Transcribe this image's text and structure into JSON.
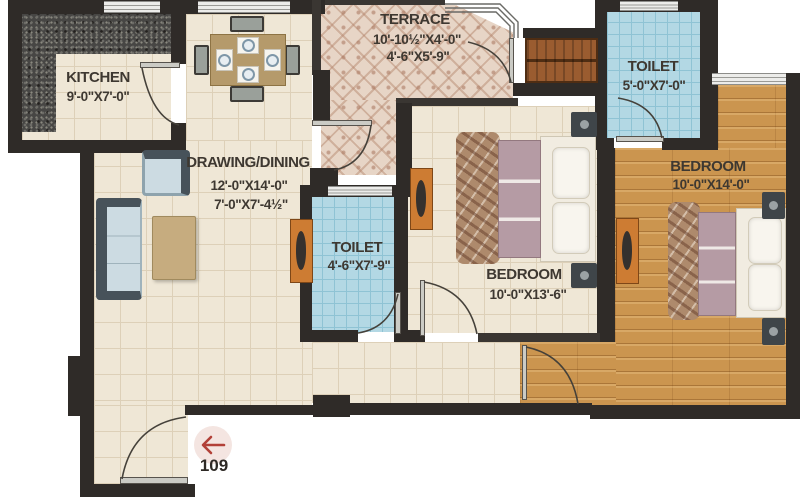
{
  "plan": {
    "unit_number": "109",
    "rooms": {
      "kitchen": {
        "name": "KITCHEN",
        "dims": "9'-0\"X7'-0\""
      },
      "terrace": {
        "name": "TERRACE",
        "dims1": "10'-10½\"X4'-0\"",
        "dims2": "4'-6\"X5'-9\""
      },
      "toilet_top": {
        "name": "TOILET",
        "dims": "5'-0\"X7'-0\""
      },
      "toilet_mid": {
        "name": "TOILET",
        "dims": "4'-6\"X7'-9\""
      },
      "drawing_dining": {
        "name": "DRAWING/DINING",
        "dims1": "12'-0\"X14'-0\"",
        "dims2": "7'-0\"X7'-4½\""
      },
      "bedroom_mid": {
        "name": "BEDROOM",
        "dims": "10'-0\"X13'-6\""
      },
      "bedroom_right": {
        "name": "BEDROOM",
        "dims": "10'-0\"X14'-0\""
      }
    },
    "colors": {
      "wall": "#2f2b28",
      "floor_tile": "#efe7d6",
      "terrace_tile": "#e7d5c6",
      "toilet_tile": "#b3d8e4",
      "wood_floor": "#cb954f",
      "accent_red": "#b24038",
      "label_text": "#3e3831"
    }
  }
}
